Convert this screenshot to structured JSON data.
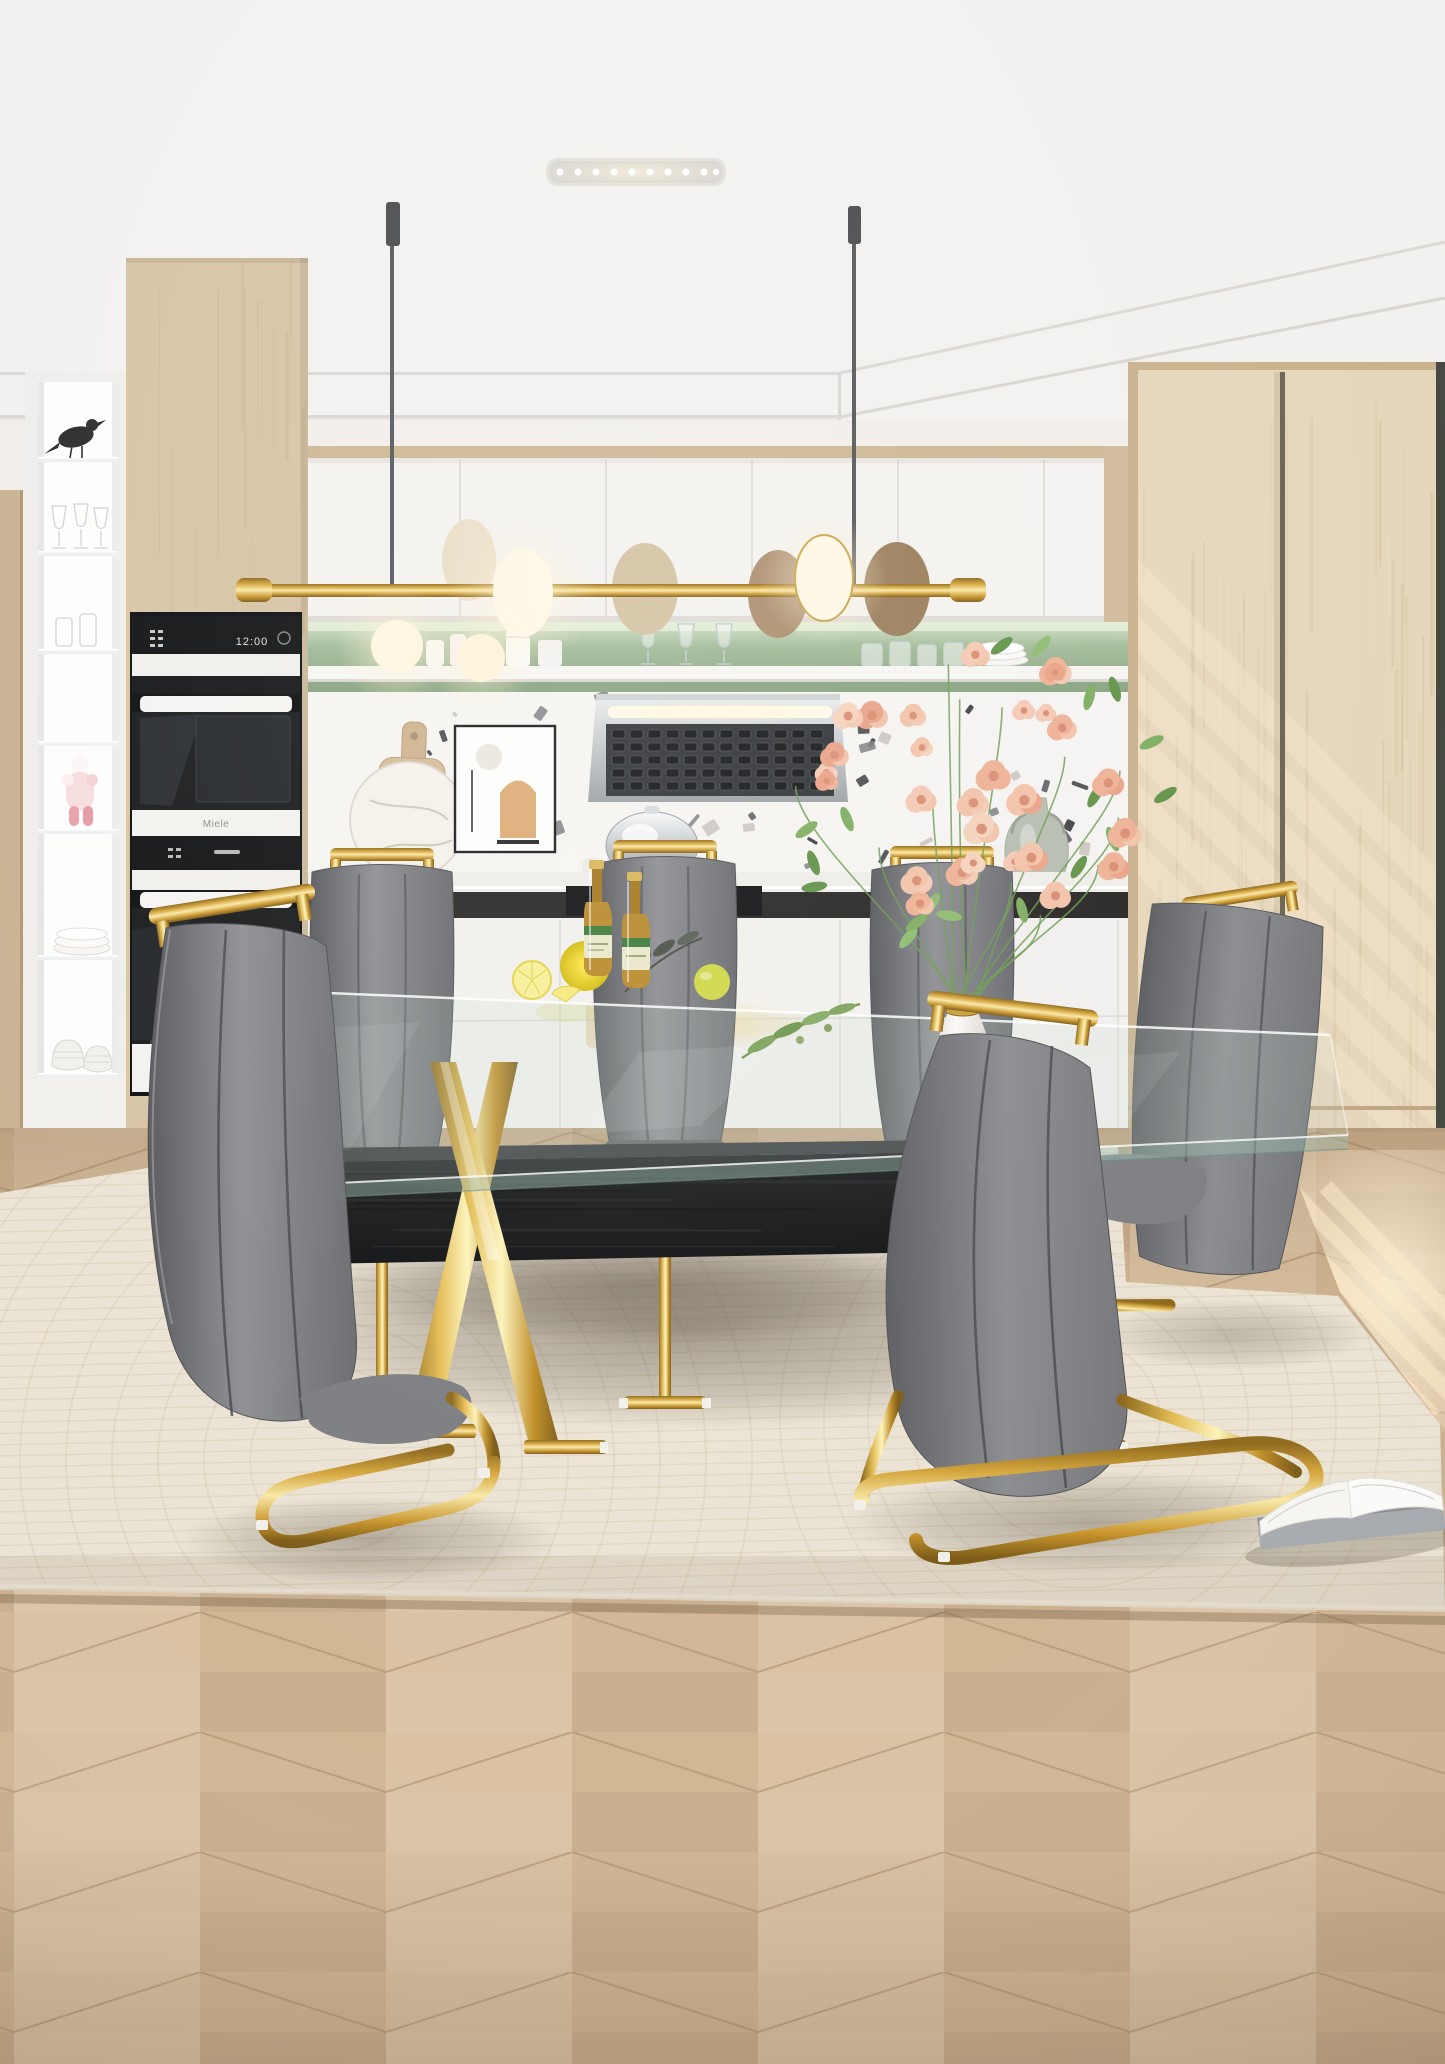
{
  "scene": {
    "description": "Photorealistic interior render: modern dining set with rectangular tempered-glass table on gold plated X-shaped legs, black oak bench, and six grey PU-leather high-back chairs with gold C-shaped cantilever bases, staged in a white and light-oak kitchen with sage-green open shelf, terrazzo backsplash, brass linear pendant light and chevron oak floor with a cream area rug",
    "type": "furniture product photograph"
  },
  "appliances": {
    "oven_brand": "Miele",
    "oven_clock": "12:00",
    "lower_oven_brand": "Miele"
  },
  "objects": {
    "pendant": "brass linear pendant with disc diffusers and glowing glass spheres",
    "display_cabinet": "white lit china cabinet with bird figure, stemware, art toy, plates and bowls",
    "kitchen": "Miele double wall ovens, stainless range hood, chafing dish, terrazzo splashback",
    "tabletop": "white and gold vase with peach roses, two beer bottles, lemons, olive sprig",
    "floor_items": "open book on rug"
  },
  "palette": {
    "gold": "#d5a63c",
    "chair_grey": "#7e7f83",
    "wood_light": "#d9c6a8",
    "sage_green": "#9cb694",
    "rug_cream": "#eae3d4",
    "floor_oak": "#d5bc9d",
    "bench_black": "#1b1c1e",
    "terrazzo_chip": "#2c2d2f"
  }
}
